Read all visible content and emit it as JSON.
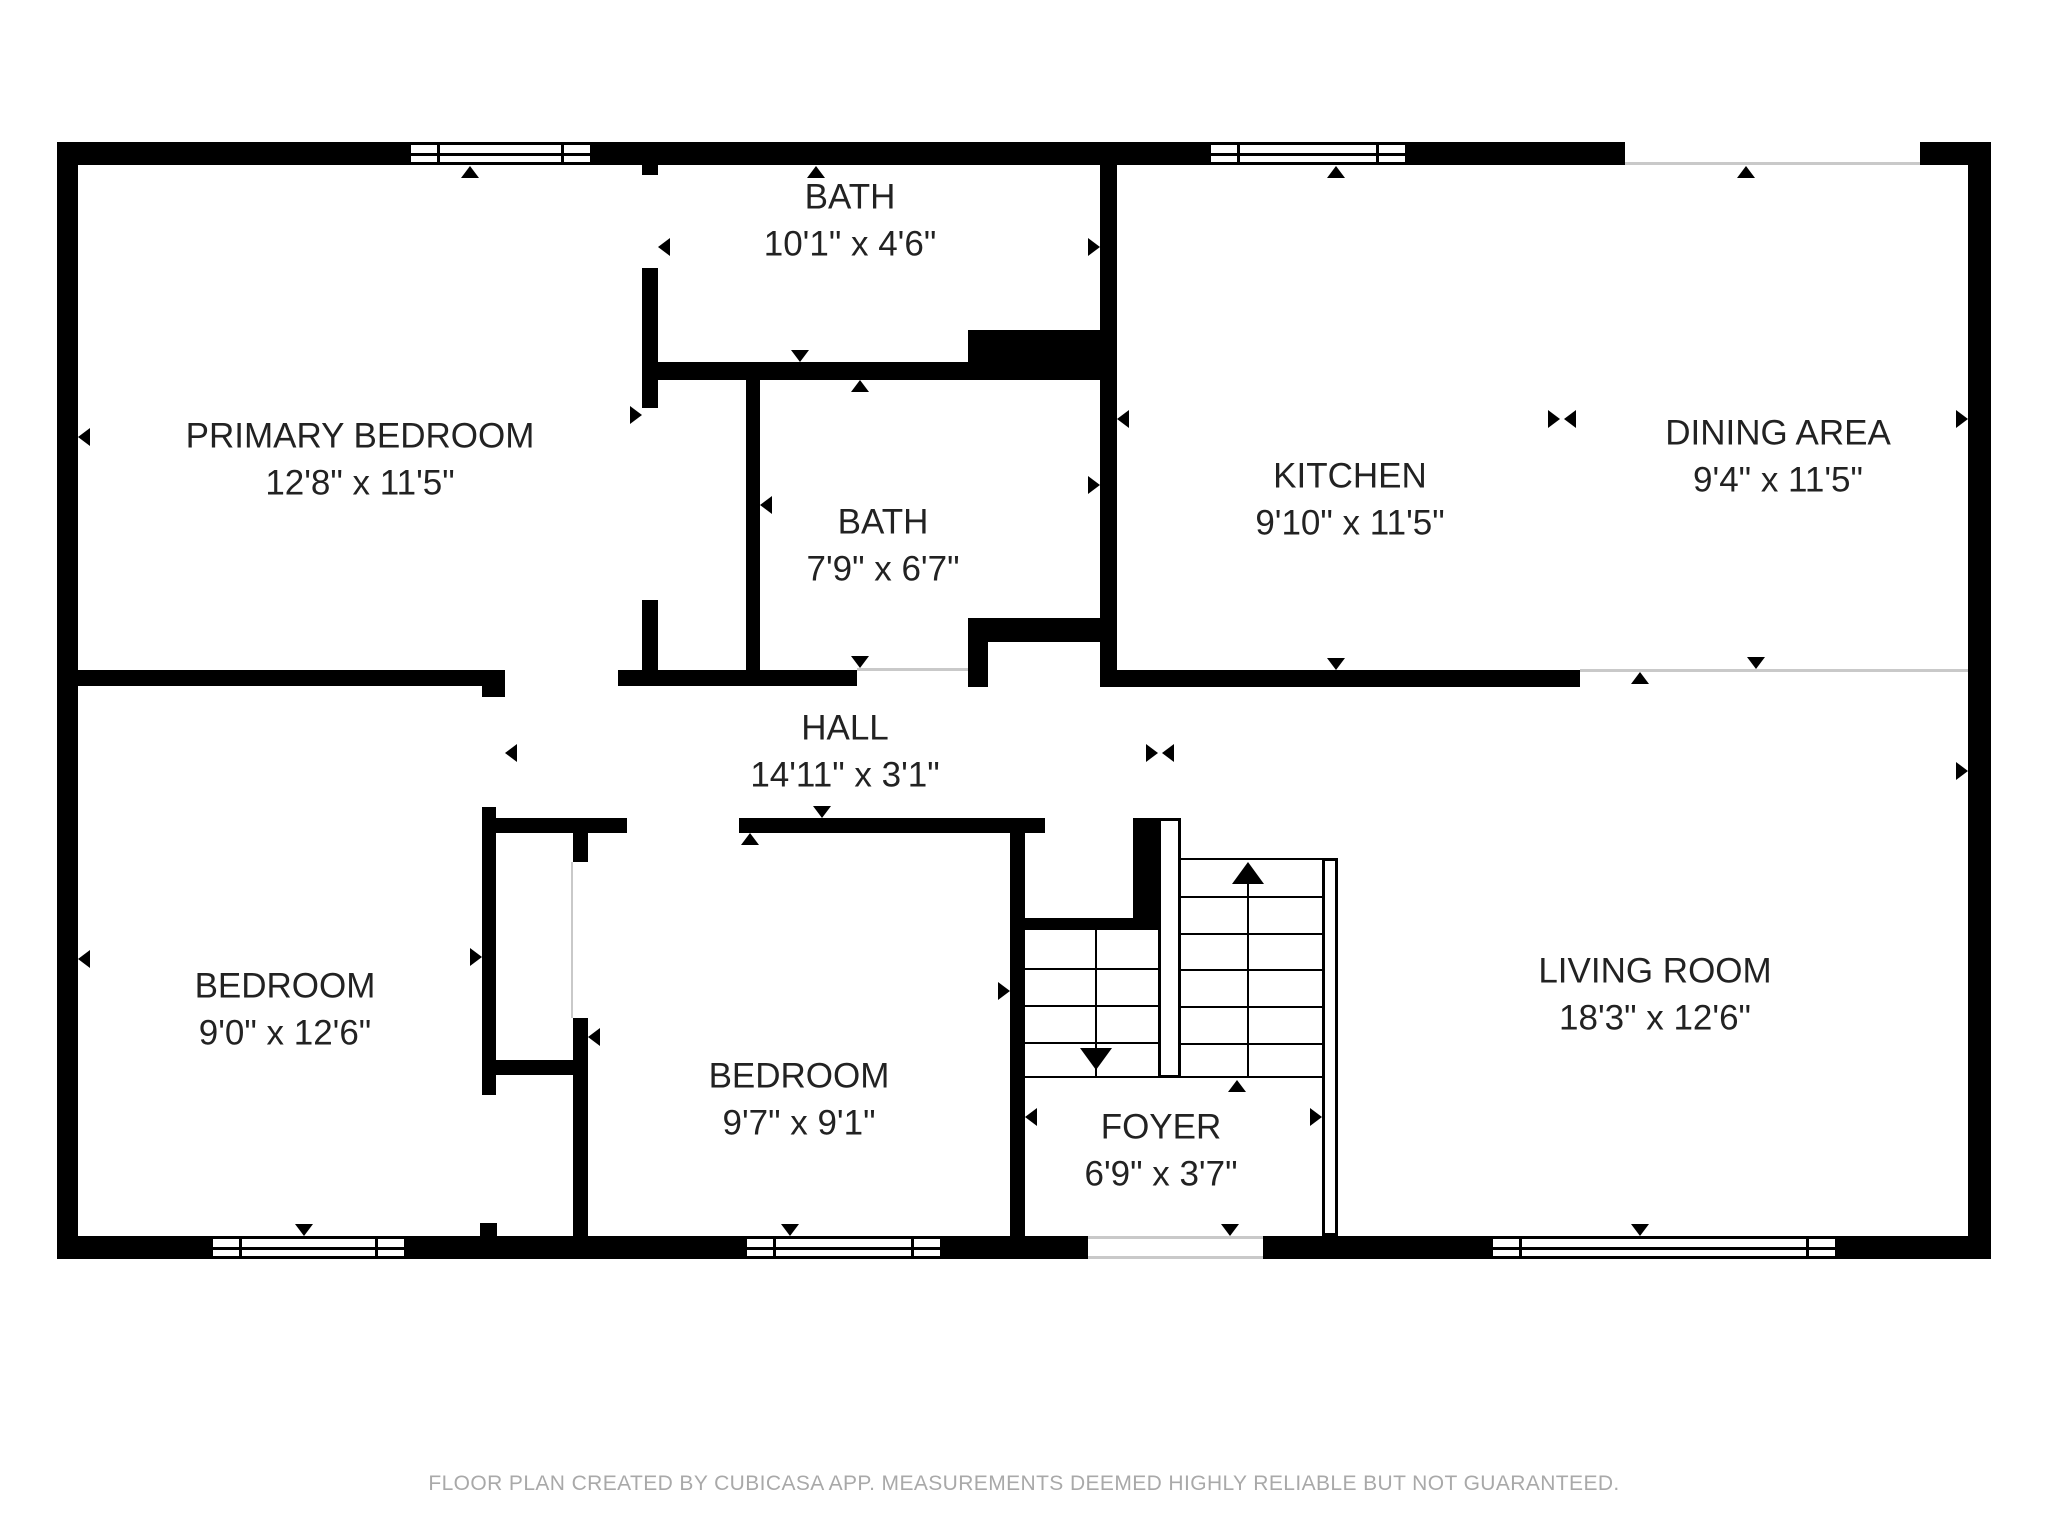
{
  "plan": {
    "rooms": {
      "primary_bedroom": {
        "name": "PRIMARY BEDROOM",
        "dims": "12'8\" x 11'5\""
      },
      "bath_top": {
        "name": "BATH",
        "dims": "10'1\" x 4'6\""
      },
      "kitchen": {
        "name": "KITCHEN",
        "dims": "9'10\" x 11'5\""
      },
      "dining_area": {
        "name": "DINING AREA",
        "dims": "9'4\" x 11'5\""
      },
      "bath_middle": {
        "name": "BATH",
        "dims": "7'9\" x 6'7\""
      },
      "hall": {
        "name": "HALL",
        "dims": "14'11\" x 3'1\""
      },
      "bedroom_left": {
        "name": "BEDROOM",
        "dims": "9'0\" x 12'6\""
      },
      "bedroom_center": {
        "name": "BEDROOM",
        "dims": "9'7\" x 9'1\""
      },
      "foyer": {
        "name": "FOYER",
        "dims": "6'9\" x 3'7\""
      },
      "living_room": {
        "name": "LIVING ROOM",
        "dims": "18'3\" x 12'6\""
      }
    },
    "footer": "FLOOR PLAN CREATED BY CUBICASA APP. MEASUREMENTS DEEMED HIGHLY RELIABLE BUT NOT GUARANTEED.",
    "colors": {
      "wall": "#000000",
      "background": "#ffffff",
      "footer_text": "#a9a9a9",
      "opening_line": "#c9c9c9",
      "label_text": "#222222"
    }
  }
}
